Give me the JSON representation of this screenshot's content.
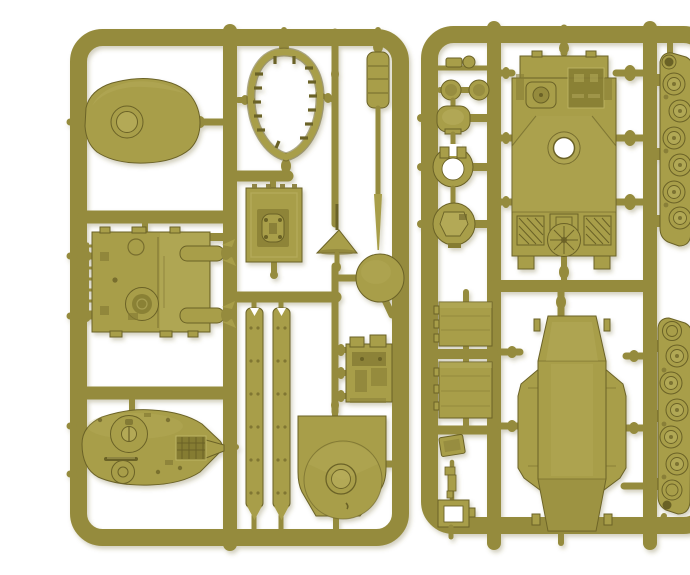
{
  "scene": {
    "subject": "Photograph of two olive-drab plastic model kit sprues with tank parts on a white background",
    "label_left": "Left sprue frame with turret, hull deck and skirt parts",
    "label_right": "Right sprue frame with hull top, hull tub and track runs"
  },
  "colors": {
    "background": "#ffffff",
    "frame": "#958b3e",
    "plastic": "#a89e4a",
    "light": "#bdb464",
    "dark": "#857b33",
    "deep": "#6b6227"
  },
  "sprues": {
    "left": {
      "label": "Left sprue",
      "parts": [
        "turret roof with round hatch",
        "open gun-shield ring with cast notches",
        "engine hatch plate",
        "antenna rod with cone base",
        "gun barrel with recuperator sleeve",
        "turret ring disc",
        "superstructure deck with ladder grille and exhaust arms",
        "side skirt strip (x2, riveted)",
        "gun breech block",
        "turret base plate with large ring",
        "turret top with cupola, grille and handle"
      ]
    },
    "right": {
      "label": "Right sprue",
      "parts": [
        "lifting knob",
        "twin hatch discs",
        "rounded crew hatch",
        "open mantlet ring",
        "cupola hatch with split doors",
        "armour plate (x2, hinged edge)",
        "stowage box",
        "machine-gun piece",
        "open hatch frame",
        "hull top deck with turret-ring hole, grilles and cooling fan",
        "hull tub with side sponsons",
        "track run with six road wheels (x2)"
      ]
    },
    "road_wheels_per_track": 6
  }
}
